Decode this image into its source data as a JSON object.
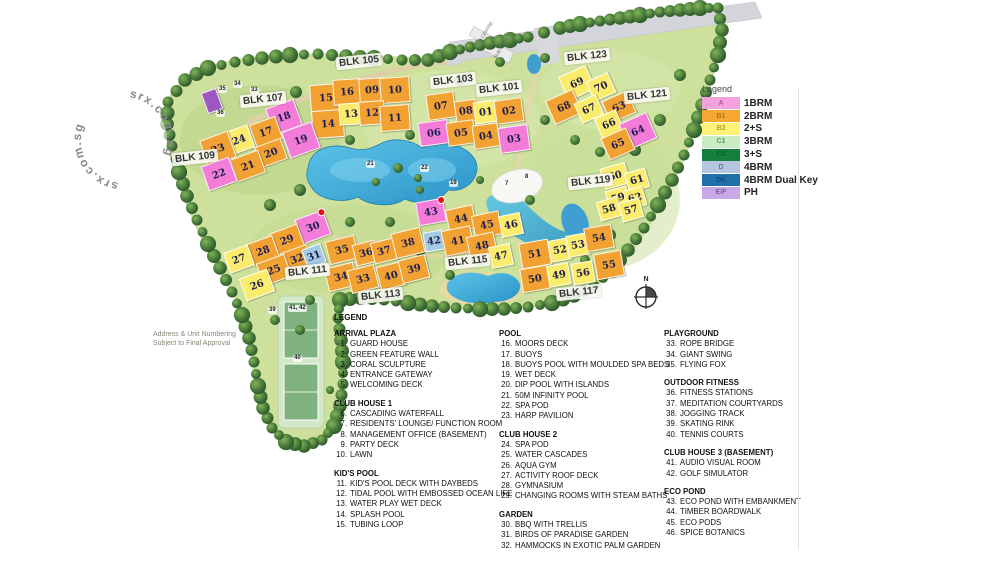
{
  "watermark": {
    "text": "srx.com.sg"
  },
  "disclaimer": {
    "line1": "Address & Unit Numbering",
    "line2": "Subject to Final Approval"
  },
  "unit_legend": {
    "title": "Legend",
    "items": [
      {
        "code": "A",
        "label": "1BRM",
        "color": "#f3a3dc",
        "code_color": "#c050b0"
      },
      {
        "code": "B1",
        "label": "2BRM",
        "color": "#f5a733",
        "code_color": "#a8761a"
      },
      {
        "code": "B2",
        "label": "2+S",
        "color": "#fdf277",
        "code_color": "#b5a51e"
      },
      {
        "code": "C1",
        "label": "3BRM",
        "color": "#c9ecc4",
        "code_color": "#4f9e5a"
      },
      {
        "code": "C2",
        "label": "3+S",
        "color": "#15803c",
        "code_color": "#0c5c2a"
      },
      {
        "code": "D",
        "label": "4BRM",
        "color": "#b6c6e0",
        "code_color": "#5f7aaa"
      },
      {
        "code": "DK",
        "label": "4BRM Dual Key",
        "color": "#1f6fa8",
        "code_color": "#144f7c"
      },
      {
        "code": "E/F",
        "label": "PH",
        "color": "#c9a8e8",
        "code_color": "#8a56b0"
      }
    ]
  },
  "map": {
    "compass_label": "N",
    "colors": {
      "o": "#f2a233",
      "y": "#fbec6d",
      "p": "#f27cd8",
      "b": "#a4c9e2",
      "v": "#9c58c0"
    },
    "block_labels": [
      {
        "text": "BLK 105",
        "x": 336,
        "y": 55
      },
      {
        "text": "BLK 103",
        "x": 430,
        "y": 74
      },
      {
        "text": "BLK 101",
        "x": 476,
        "y": 82
      },
      {
        "text": "BLK 107",
        "x": 240,
        "y": 93
      },
      {
        "text": "BLK 109",
        "x": 172,
        "y": 151
      },
      {
        "text": "BLK 111",
        "x": 285,
        "y": 265
      },
      {
        "text": "BLK 113",
        "x": 358,
        "y": 289
      },
      {
        "text": "BLK 115",
        "x": 445,
        "y": 255
      },
      {
        "text": "BLK 117",
        "x": 556,
        "y": 286
      },
      {
        "text": "BLK 119",
        "x": 568,
        "y": 175
      },
      {
        "text": "BLK 121",
        "x": 624,
        "y": 89
      },
      {
        "text": "BLK 123",
        "x": 564,
        "y": 50
      }
    ],
    "buildings": [
      {
        "n": "15",
        "x": 310,
        "y": 84,
        "w": 30,
        "h": 26,
        "c": "o",
        "r": -4
      },
      {
        "n": "16",
        "x": 333,
        "y": 79,
        "w": 26,
        "h": 24,
        "c": "o",
        "r": -4
      },
      {
        "n": "09",
        "x": 359,
        "y": 78,
        "w": 24,
        "h": 22,
        "c": "o",
        "r": -4
      },
      {
        "n": "10",
        "x": 380,
        "y": 77,
        "w": 28,
        "h": 24,
        "c": "o",
        "r": -4
      },
      {
        "n": "14",
        "x": 312,
        "y": 110,
        "w": 30,
        "h": 26,
        "c": "o",
        "r": -4
      },
      {
        "n": "13",
        "x": 339,
        "y": 103,
        "w": 22,
        "h": 20,
        "c": "y",
        "r": -4
      },
      {
        "n": "12",
        "x": 359,
        "y": 101,
        "w": 24,
        "h": 22,
        "c": "o",
        "r": -4
      },
      {
        "n": "11",
        "x": 380,
        "y": 105,
        "w": 28,
        "h": 24,
        "c": "o",
        "r": -4
      },
      {
        "n": "07",
        "x": 427,
        "y": 93,
        "w": 26,
        "h": 24,
        "c": "o",
        "r": -8
      },
      {
        "n": "08",
        "x": 455,
        "y": 100,
        "w": 20,
        "h": 20,
        "c": "o",
        "r": -8
      },
      {
        "n": "06",
        "x": 419,
        "y": 121,
        "w": 28,
        "h": 22,
        "c": "p",
        "r": -8
      },
      {
        "n": "05",
        "x": 447,
        "y": 121,
        "w": 26,
        "h": 22,
        "c": "o",
        "r": -8
      },
      {
        "n": "01",
        "x": 474,
        "y": 101,
        "w": 22,
        "h": 20,
        "c": "y",
        "r": -8
      },
      {
        "n": "02",
        "x": 495,
        "y": 99,
        "w": 26,
        "h": 22,
        "c": "o",
        "r": -8
      },
      {
        "n": "04",
        "x": 473,
        "y": 124,
        "w": 24,
        "h": 22,
        "c": "o",
        "r": -8
      },
      {
        "n": "03",
        "x": 499,
        "y": 126,
        "w": 28,
        "h": 24,
        "c": "p",
        "r": -8
      },
      {
        "n": "18",
        "x": 269,
        "y": 103,
        "w": 28,
        "h": 26,
        "c": "p",
        "r": -20
      },
      {
        "n": "17",
        "x": 252,
        "y": 120,
        "w": 26,
        "h": 22,
        "c": "o",
        "r": -20
      },
      {
        "n": "19",
        "x": 285,
        "y": 126,
        "w": 30,
        "h": 26,
        "c": "p",
        "r": -20
      },
      {
        "n": "24",
        "x": 226,
        "y": 128,
        "w": 24,
        "h": 22,
        "c": "y",
        "r": -20
      },
      {
        "n": "23",
        "x": 203,
        "y": 135,
        "w": 28,
        "h": 26,
        "c": "o",
        "r": -20
      },
      {
        "n": "20",
        "x": 257,
        "y": 142,
        "w": 26,
        "h": 20,
        "c": "o",
        "r": -20
      },
      {
        "n": "21",
        "x": 233,
        "y": 154,
        "w": 28,
        "h": 22,
        "c": "o",
        "r": -20
      },
      {
        "n": "22",
        "x": 204,
        "y": 161,
        "w": 28,
        "h": 24,
        "c": "p",
        "r": -20
      },
      {
        "n": "",
        "x": 204,
        "y": 90,
        "w": 14,
        "h": 20,
        "c": "v",
        "r": -20
      },
      {
        "n": "30",
        "x": 298,
        "y": 214,
        "w": 28,
        "h": 24,
        "c": "p",
        "r": -20,
        "dot": true
      },
      {
        "n": "29",
        "x": 272,
        "y": 228,
        "w": 28,
        "h": 22,
        "c": "o",
        "r": -20
      },
      {
        "n": "28",
        "x": 249,
        "y": 239,
        "w": 26,
        "h": 22,
        "c": "o",
        "r": -20
      },
      {
        "n": "27",
        "x": 226,
        "y": 248,
        "w": 24,
        "h": 20,
        "c": "y",
        "r": -20
      },
      {
        "n": "32",
        "x": 283,
        "y": 248,
        "w": 26,
        "h": 20,
        "c": "o",
        "r": -20
      },
      {
        "n": "31",
        "x": 304,
        "y": 246,
        "w": 18,
        "h": 18,
        "c": "b",
        "r": -20
      },
      {
        "n": "25",
        "x": 259,
        "y": 258,
        "w": 28,
        "h": 22,
        "c": "o",
        "r": -20
      },
      {
        "n": "26",
        "x": 242,
        "y": 273,
        "w": 28,
        "h": 22,
        "c": "y",
        "r": -20
      },
      {
        "n": "35",
        "x": 327,
        "y": 238,
        "w": 28,
        "h": 22,
        "c": "o",
        "r": -14
      },
      {
        "n": "36",
        "x": 354,
        "y": 242,
        "w": 22,
        "h": 20,
        "c": "o",
        "r": -14
      },
      {
        "n": "37",
        "x": 372,
        "y": 240,
        "w": 22,
        "h": 20,
        "c": "o",
        "r": -14
      },
      {
        "n": "38",
        "x": 393,
        "y": 230,
        "w": 28,
        "h": 24,
        "c": "o",
        "r": -14
      },
      {
        "n": "34",
        "x": 326,
        "y": 265,
        "w": 28,
        "h": 22,
        "c": "o",
        "r": -14
      },
      {
        "n": "33",
        "x": 349,
        "y": 267,
        "w": 26,
        "h": 22,
        "c": "o",
        "r": -14
      },
      {
        "n": "40",
        "x": 378,
        "y": 264,
        "w": 24,
        "h": 22,
        "c": "o",
        "r": -14
      },
      {
        "n": "39",
        "x": 400,
        "y": 257,
        "w": 26,
        "h": 22,
        "c": "o",
        "r": -14
      },
      {
        "n": "43",
        "x": 417,
        "y": 200,
        "w": 26,
        "h": 22,
        "c": "p",
        "r": -10,
        "dot": true
      },
      {
        "n": "42",
        "x": 424,
        "y": 231,
        "w": 18,
        "h": 18,
        "c": "b",
        "r": -10
      },
      {
        "n": "44",
        "x": 447,
        "y": 207,
        "w": 26,
        "h": 22,
        "c": "o",
        "r": -12
      },
      {
        "n": "41",
        "x": 443,
        "y": 228,
        "w": 28,
        "h": 24,
        "c": "o",
        "r": -12
      },
      {
        "n": "45",
        "x": 473,
        "y": 213,
        "w": 26,
        "h": 22,
        "c": "o",
        "r": -12
      },
      {
        "n": "46",
        "x": 500,
        "y": 214,
        "w": 20,
        "h": 20,
        "c": "y",
        "r": -12
      },
      {
        "n": "48",
        "x": 468,
        "y": 234,
        "w": 26,
        "h": 22,
        "c": "o",
        "r": -12
      },
      {
        "n": "47",
        "x": 490,
        "y": 245,
        "w": 20,
        "h": 20,
        "c": "y",
        "r": -12
      },
      {
        "n": "51",
        "x": 520,
        "y": 241,
        "w": 28,
        "h": 24,
        "c": "o",
        "r": -10
      },
      {
        "n": "52",
        "x": 549,
        "y": 239,
        "w": 20,
        "h": 20,
        "c": "y",
        "r": -10
      },
      {
        "n": "53",
        "x": 567,
        "y": 234,
        "w": 20,
        "h": 20,
        "c": "y",
        "r": -10
      },
      {
        "n": "54",
        "x": 585,
        "y": 226,
        "w": 26,
        "h": 22,
        "c": "o",
        "r": -10
      },
      {
        "n": "50",
        "x": 521,
        "y": 267,
        "w": 26,
        "h": 22,
        "c": "o",
        "r": -10
      },
      {
        "n": "49",
        "x": 548,
        "y": 264,
        "w": 20,
        "h": 20,
        "c": "y",
        "r": -10
      },
      {
        "n": "56",
        "x": 572,
        "y": 262,
        "w": 20,
        "h": 20,
        "c": "y",
        "r": -10
      },
      {
        "n": "55",
        "x": 595,
        "y": 252,
        "w": 26,
        "h": 24,
        "c": "o",
        "r": -10
      },
      {
        "n": "69",
        "x": 562,
        "y": 70,
        "w": 28,
        "h": 24,
        "c": "y",
        "r": -24
      },
      {
        "n": "70",
        "x": 589,
        "y": 76,
        "w": 22,
        "h": 20,
        "c": "y",
        "r": -24
      },
      {
        "n": "68",
        "x": 549,
        "y": 94,
        "w": 28,
        "h": 24,
        "c": "o",
        "r": -24
      },
      {
        "n": "67",
        "x": 577,
        "y": 98,
        "w": 22,
        "h": 20,
        "c": "y",
        "r": -24
      },
      {
        "n": "63",
        "x": 605,
        "y": 95,
        "w": 26,
        "h": 22,
        "c": "o",
        "r": -24
      },
      {
        "n": "66",
        "x": 597,
        "y": 113,
        "w": 22,
        "h": 20,
        "c": "y",
        "r": -24
      },
      {
        "n": "64",
        "x": 623,
        "y": 117,
        "w": 28,
        "h": 26,
        "c": "p",
        "r": -24
      },
      {
        "n": "65",
        "x": 604,
        "y": 132,
        "w": 26,
        "h": 22,
        "c": "o",
        "r": -24
      },
      {
        "n": "60",
        "x": 602,
        "y": 165,
        "w": 24,
        "h": 20,
        "c": "y",
        "r": -16
      },
      {
        "n": "61",
        "x": 626,
        "y": 170,
        "w": 20,
        "h": 18,
        "c": "y",
        "r": -16
      },
      {
        "n": "59",
        "x": 607,
        "y": 188,
        "w": 20,
        "h": 18,
        "c": "y",
        "r": -16
      },
      {
        "n": "62",
        "x": 625,
        "y": 188,
        "w": 18,
        "h": 18,
        "c": "y",
        "r": -16
      },
      {
        "n": "58",
        "x": 598,
        "y": 199,
        "w": 20,
        "h": 18,
        "c": "y",
        "r": -16
      },
      {
        "n": "57",
        "x": 620,
        "y": 200,
        "w": 20,
        "h": 18,
        "c": "y",
        "r": -16
      }
    ],
    "point_labels": [
      {
        "t": "35",
        "x": 218,
        "y": 86
      },
      {
        "t": "34",
        "x": 233,
        "y": 81
      },
      {
        "t": "33",
        "x": 250,
        "y": 87
      },
      {
        "t": "36",
        "x": 216,
        "y": 110
      },
      {
        "t": "21",
        "x": 366,
        "y": 161
      },
      {
        "t": "22",
        "x": 420,
        "y": 165
      },
      {
        "t": "19",
        "x": 449,
        "y": 180
      },
      {
        "t": "7",
        "x": 504,
        "y": 181
      },
      {
        "t": "8",
        "x": 524,
        "y": 174
      },
      {
        "t": "39",
        "x": 268,
        "y": 307
      },
      {
        "t": "41, 42",
        "x": 288,
        "y": 305
      },
      {
        "t": "40",
        "x": 293,
        "y": 355
      },
      {
        "t": "BIN CENTRE",
        "x": 470,
        "y": 30,
        "rot": -58,
        "tiny": true
      },
      {
        "t": "SUB STATION",
        "x": 487,
        "y": 42,
        "rot": -58,
        "tiny": true
      }
    ]
  },
  "amenity_legend": {
    "title": "LEGEND",
    "columns": [
      {
        "sections": [
          {
            "heading": "ARRIVAL PLAZA",
            "items": [
              {
                "n": "1",
                "t": "GUARD HOUSE"
              },
              {
                "n": "2",
                "t": "GREEN FEATURE WALL"
              },
              {
                "n": "3",
                "t": "CORAL SCULPTURE"
              },
              {
                "n": "4",
                "t": "ENTRANCE GATEWAY"
              },
              {
                "n": "5",
                "t": "WELCOMING DECK"
              }
            ]
          },
          {
            "heading": "CLUB HOUSE 1",
            "items": [
              {
                "n": "6",
                "t": "CASCADING WATERFALL"
              },
              {
                "n": "7",
                "t": "RESIDENTS' LOUNGE/ FUNCTION ROOM"
              },
              {
                "n": "8",
                "t": "MANAGEMENT OFFICE (BASEMENT)"
              },
              {
                "n": "9",
                "t": "PARTY DECK"
              },
              {
                "n": "10",
                "t": "LAWN"
              }
            ]
          },
          {
            "heading": "KID'S POOL",
            "items": [
              {
                "n": "11",
                "t": "KID'S POOL DECK WITH DAYBEDS"
              },
              {
                "n": "12",
                "t": "TIDAL POOL WITH EMBOSSED OCEAN LIFE"
              },
              {
                "n": "13",
                "t": "WATER PLAY WET DECK"
              },
              {
                "n": "14",
                "t": "SPLASH POOL"
              },
              {
                "n": "15",
                "t": "TUBING LOOP"
              }
            ]
          }
        ]
      },
      {
        "sections": [
          {
            "heading": "POOL",
            "items": [
              {
                "n": "16",
                "t": "MOORS DECK"
              },
              {
                "n": "17",
                "t": "BUOYS"
              },
              {
                "n": "18",
                "t": "BUOYS POOL WITH MOULDED SPA BEDS"
              },
              {
                "n": "19",
                "t": "WET DECK"
              },
              {
                "n": "20",
                "t": "DIP POOL WITH ISLANDS"
              },
              {
                "n": "21",
                "t": "50M INFINITY POOL"
              },
              {
                "n": "22",
                "t": "SPA POD"
              },
              {
                "n": "23",
                "t": "HARP PAVILION"
              }
            ]
          },
          {
            "heading": "CLUB HOUSE 2",
            "items": [
              {
                "n": "24",
                "t": "SPA POD"
              },
              {
                "n": "25",
                "t": "WATER CASCADES"
              },
              {
                "n": "26",
                "t": "AQUA GYM"
              },
              {
                "n": "27",
                "t": "ACTIVITY ROOF DECK"
              },
              {
                "n": "28",
                "t": "GYMNASIUM"
              },
              {
                "n": "29",
                "t": "CHANGING ROOMS WITH STEAM BATHS"
              }
            ]
          },
          {
            "heading": "GARDEN",
            "items": [
              {
                "n": "30",
                "t": "BBQ WITH TRELLIS"
              },
              {
                "n": "31",
                "t": "BIRDS OF PARADISE GARDEN"
              },
              {
                "n": "32",
                "t": "HAMMOCKS IN EXOTIC PALM GARDEN"
              }
            ]
          }
        ]
      },
      {
        "sections": [
          {
            "heading": "PLAYGROUND",
            "items": [
              {
                "n": "33",
                "t": "ROPE BRIDGE"
              },
              {
                "n": "34",
                "t": "GIANT SWING"
              },
              {
                "n": "35",
                "t": "FLYING FOX"
              }
            ]
          },
          {
            "heading": "OUTDOOR FITNESS",
            "items": [
              {
                "n": "36",
                "t": "FITNESS STATIONS"
              },
              {
                "n": "37",
                "t": "MEDITATION COURTYARDS"
              },
              {
                "n": "38",
                "t": "JOGGING TRACK"
              },
              {
                "n": "39",
                "t": "SKATING RINK"
              },
              {
                "n": "40",
                "t": "TENNIS COURTS"
              }
            ]
          },
          {
            "heading": "CLUB HOUSE 3 (BASEMENT)",
            "items": [
              {
                "n": "41",
                "t": "AUDIO VISUAL ROOM"
              },
              {
                "n": "42",
                "t": "GOLF SIMULATOR"
              }
            ]
          },
          {
            "heading": "ECO POND",
            "items": [
              {
                "n": "43",
                "t": "ECO POND WITH EMBANKMENT"
              },
              {
                "n": "44",
                "t": "TIMBER BOARDWALK"
              },
              {
                "n": "45",
                "t": "ECO PODS"
              },
              {
                "n": "46",
                "t": "SPICE BOTANICS"
              }
            ]
          }
        ]
      }
    ]
  }
}
